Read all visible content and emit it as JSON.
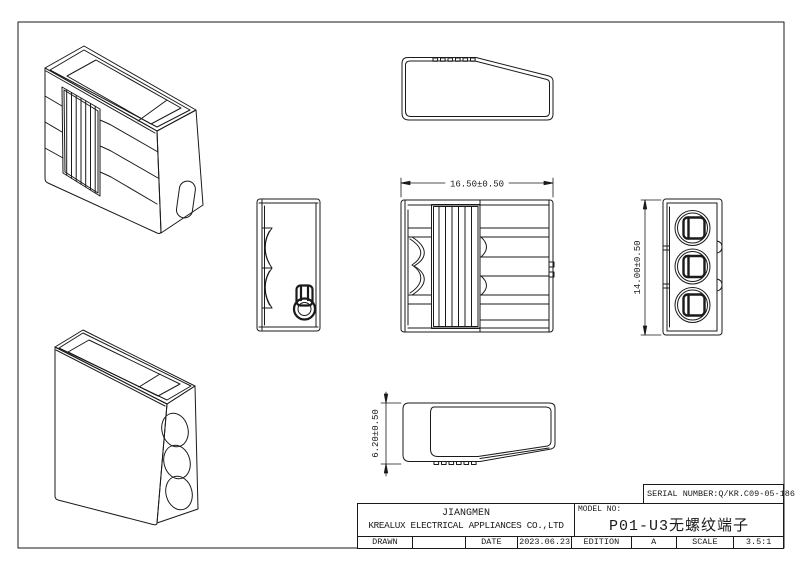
{
  "title_block": {
    "serial_label": "SERIAL NUMBER:Q/KR.C09-05-186",
    "company_line1": "JIANGMEN",
    "company_line2": "KREALUX ELECTRICAL APPLIANCES CO.,LTD",
    "model_no_label": "MODEL NO:",
    "model_name": "P01-U3无螺纹端子",
    "cells": [
      "DRAWN",
      "",
      "DATE",
      "2023.06.23",
      "EDITION",
      "A",
      "SCALE",
      "3.5:1"
    ]
  },
  "dimensions": {
    "width": "16.50±0.50",
    "height": "14.00±0.50",
    "depth": "6.20±0.50"
  },
  "colors": {
    "line": "#1a1a1a",
    "background": "#ffffff"
  }
}
